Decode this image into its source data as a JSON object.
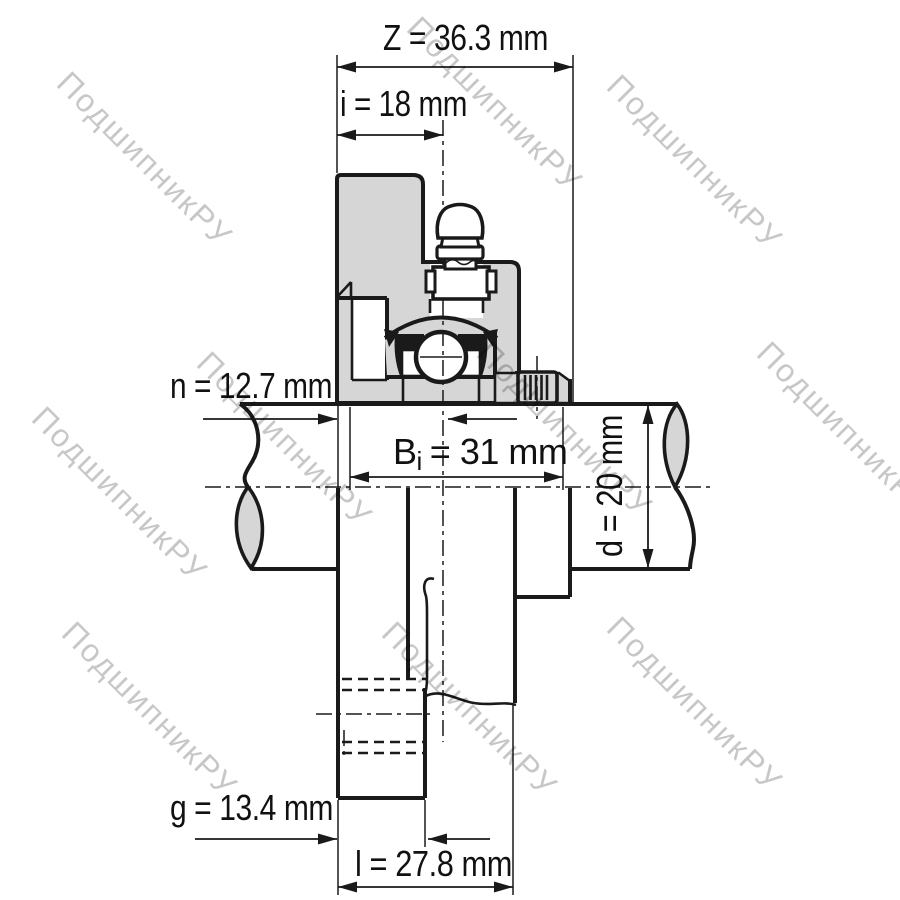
{
  "drawing": {
    "title": "flanged-bearing-unit-cross-section"
  },
  "watermark": {
    "text": "ПодшипникРУ"
  },
  "dimensions": {
    "z": {
      "label": "Z = 36.3 mm"
    },
    "i": {
      "label": "i = 18 mm"
    },
    "n": {
      "label": "n = 12.7 mm"
    },
    "bi": {
      "base": "B",
      "sub": "i",
      "rest": "= 31 mm"
    },
    "d": {
      "label": "d = 20 mm"
    },
    "g": {
      "label": "g = 13.4 mm"
    },
    "l": {
      "label": "l = 27.8 mm"
    }
  },
  "colors": {
    "background": "#ffffff",
    "line": "#1a1a1a",
    "housing_fill": "#d6d6d6",
    "watermark": "#c4c4c4"
  }
}
